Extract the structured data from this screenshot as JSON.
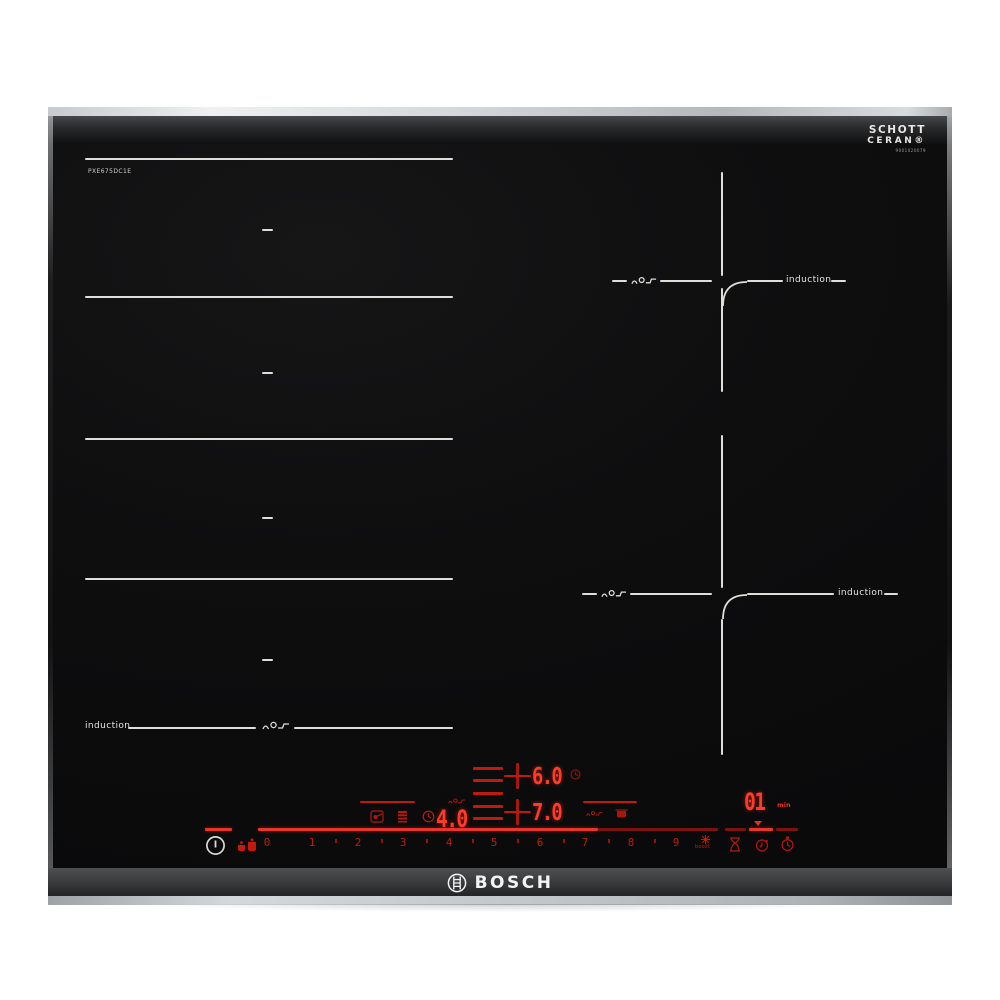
{
  "hob": {
    "brand": "BOSCH",
    "model": "PXE675DC1E",
    "glass": {
      "maker_line1": "SCHOTT",
      "maker_line2": "CERAN®",
      "maker_serial": "9001020079"
    },
    "zones": {
      "flex_left": {
        "induction_label": "induction"
      },
      "top_right": {
        "induction_label": "induction"
      },
      "bottom_right": {
        "induction_label": "induction"
      }
    },
    "panel": {
      "levels": [
        "0",
        "1",
        "2",
        "3",
        "4",
        "5",
        "6",
        "7",
        "8",
        "9"
      ],
      "boost_label": "boost",
      "displays": {
        "flex_power": "4.0",
        "top_right_power": "6.0",
        "bottom_right_power": "7.0",
        "timer": "01",
        "timer_unit": "min"
      },
      "icons": {
        "power": "power-icon",
        "pan_pair": "pan-pair-icon",
        "fry_sensor": "fry-sensor-icon",
        "keep_warm": "keep-warm-icon",
        "timer_clock": "clock-icon",
        "boost_star": "boost-star-icon",
        "hourglass": "hourglass-icon",
        "alarm_timer": "alarm-timer-icon",
        "stopwatch": "stopwatch-icon"
      }
    },
    "colors": {
      "display_red": "#ff3a28",
      "line_red": "#c2190e",
      "zone_white": "#dededa",
      "glass_black": "#0d0d0d"
    }
  }
}
